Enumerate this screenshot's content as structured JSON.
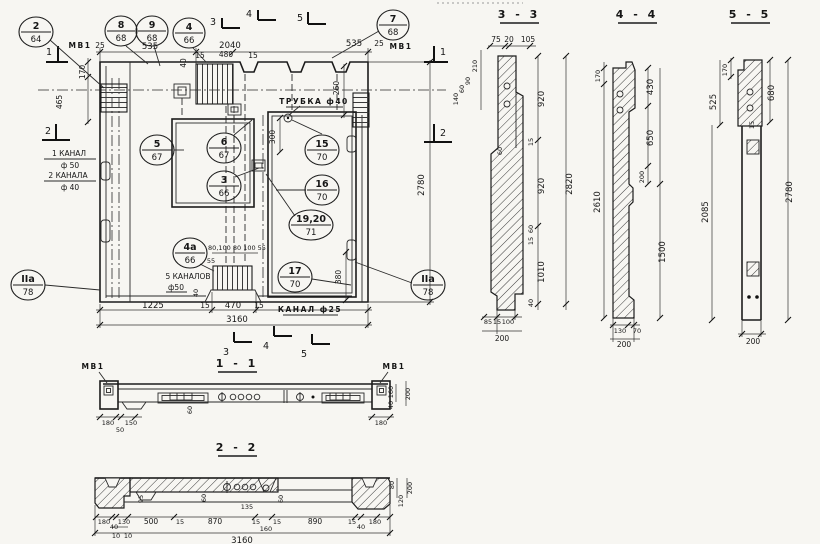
{
  "labels": {
    "mv1": "МВ1"
  },
  "main": {
    "markers": {
      "m1": "1",
      "m2": "2",
      "m3": "3",
      "m4": "4",
      "m5": "5"
    },
    "callouts": [
      {
        "num": "2",
        "sheet": "64"
      },
      {
        "num": "8",
        "sheet": "68"
      },
      {
        "num": "9",
        "sheet": "68"
      },
      {
        "num": "4",
        "sheet": "66"
      },
      {
        "num": "7",
        "sheet": "68"
      },
      {
        "num": "5",
        "sheet": "67"
      },
      {
        "num": "6",
        "sheet": "67"
      },
      {
        "num": "3",
        "sheet": "66"
      },
      {
        "num": "15",
        "sheet": "70"
      },
      {
        "num": "16",
        "sheet": "70"
      },
      {
        "num": "19,20",
        "sheet": "71"
      },
      {
        "num": "4а",
        "sheet": "66"
      },
      {
        "num": "17",
        "sheet": "70"
      },
      {
        "num": "IIа",
        "sheet": "78"
      },
      {
        "num": "IIа",
        "sheet": "78"
      }
    ],
    "dims": {
      "top_25_l": "25",
      "top_535_l": "535",
      "top_2040": "2040",
      "top_15_l": "15",
      "top_480": "480",
      "top_15_r": "15",
      "top_40": "40",
      "top_535_r": "535",
      "top_25_r": "25",
      "left_170": "170",
      "left_465": "465",
      "right_260": "260",
      "right_300": "300",
      "right_2780": "2780",
      "right_380": "380",
      "bot_1225": "1225",
      "bot_15_l": "15",
      "bot_470": "470",
      "bot_15_r": "15",
      "bot_3160": "3160",
      "comb_row": "80,100 80 100 55",
      "comb_55": "55",
      "comb_40": "40"
    },
    "labels": {
      "tube": "ТРУБКА ф40",
      "canal25": "КАНАЛ ф25",
      "canals5": "5 КАНАЛОВ",
      "canals5_d": "ф50",
      "canal1": "1 КАНАЛ",
      "canal1_d": "ф 50",
      "canal2": "2 КАНАЛА",
      "canal2_d": "ф 40"
    }
  },
  "s33": {
    "title": "3 - 3",
    "dims": {
      "t75": "75",
      "t20": "20",
      "t105": "105",
      "l210": "210",
      "l90": "90",
      "l60": "60",
      "l140": "140",
      "r920a": "920",
      "r15a": "15",
      "r60a": "60",
      "r920b": "920",
      "r60b": "60",
      "r15b": "15",
      "r1010": "1010",
      "r40": "40",
      "total": "2820",
      "b85": "85",
      "b15": "15",
      "b100": "100",
      "b200": "200"
    }
  },
  "s44": {
    "title": "4 - 4",
    "dims": {
      "t170": "170",
      "r430": "430",
      "r650": "650",
      "r200": "200",
      "r1500": "1500",
      "total": "2610",
      "b130": "130",
      "b70": "70",
      "b200": "200"
    }
  },
  "s55": {
    "title": "5 - 5",
    "dims": {
      "t170": "170",
      "l525": "525",
      "r680": "680",
      "r15": "15",
      "l2085": "2085",
      "total": "2780",
      "b200": "200"
    }
  },
  "s11": {
    "title": "1 - 1",
    "dims": {
      "b180l": "180",
      "b50": "50",
      "b150": "150",
      "b180r": "180",
      "m60": "60",
      "r40": "40",
      "r160": "160",
      "r200": "200"
    }
  },
  "s22": {
    "title": "2 - 2",
    "dims": {
      "m95": "95",
      "m60a": "60",
      "m135": "135",
      "m60b": "60",
      "b180l": "180",
      "b40l": "40",
      "b130": "130",
      "b10a": "10",
      "b10b": "10",
      "b500": "500",
      "b15a": "15",
      "b870": "870",
      "b15b": "15",
      "b160": "160",
      "b15c": "15",
      "b890": "890",
      "b15d": "15",
      "b40r": "40",
      "b180r": "180",
      "total": "3160",
      "r80": "80",
      "r120": "120",
      "r200": "200"
    }
  }
}
